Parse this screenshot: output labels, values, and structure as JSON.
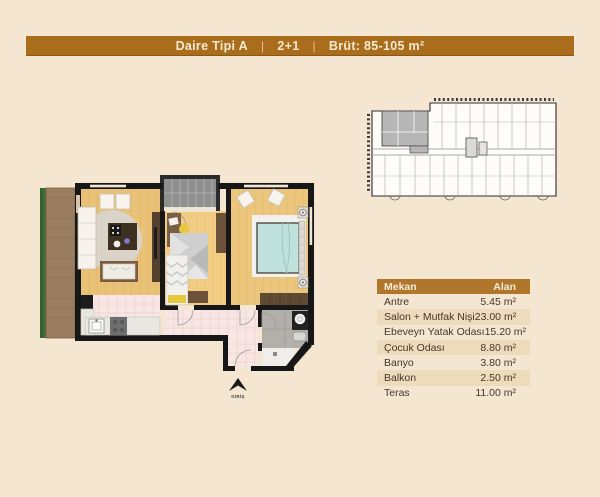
{
  "header": {
    "title": "Daire Tipi A",
    "separator": "|",
    "layout": "2+1",
    "gross_area": "Brüt: 85-105 m²"
  },
  "floor_plan": {
    "entrance_label": "GİRİŞ"
  },
  "area_table": {
    "columns": [
      "Mekan",
      "Alan"
    ],
    "rows": [
      {
        "room": "Antre",
        "area": "5.45 m²"
      },
      {
        "room": "Salon + Mutfak Nişi",
        "area": "23.00 m²"
      },
      {
        "room": "Ebeveyn Yatak Odası",
        "area": "15.20 m²"
      },
      {
        "room": "Çocuk Odası",
        "area": "8.80 m²"
      },
      {
        "room": "Banyo",
        "area": "3.80 m²"
      },
      {
        "room": "Balkon",
        "area": "2.50 m²"
      },
      {
        "room": "Teras",
        "area": "11.00 m²"
      }
    ]
  },
  "colors": {
    "page_background": "#f5e6d2",
    "banner": "#a96d1b",
    "table_header": "#b0762c",
    "table_alt_row": "#eedbbb",
    "highlight_unit_gray": "#b6b6b6",
    "wood_floor": "#e9c177",
    "wall": "#171717",
    "bed_teal": "#bfe2dd",
    "tile_pink": "#f8e6e4"
  }
}
